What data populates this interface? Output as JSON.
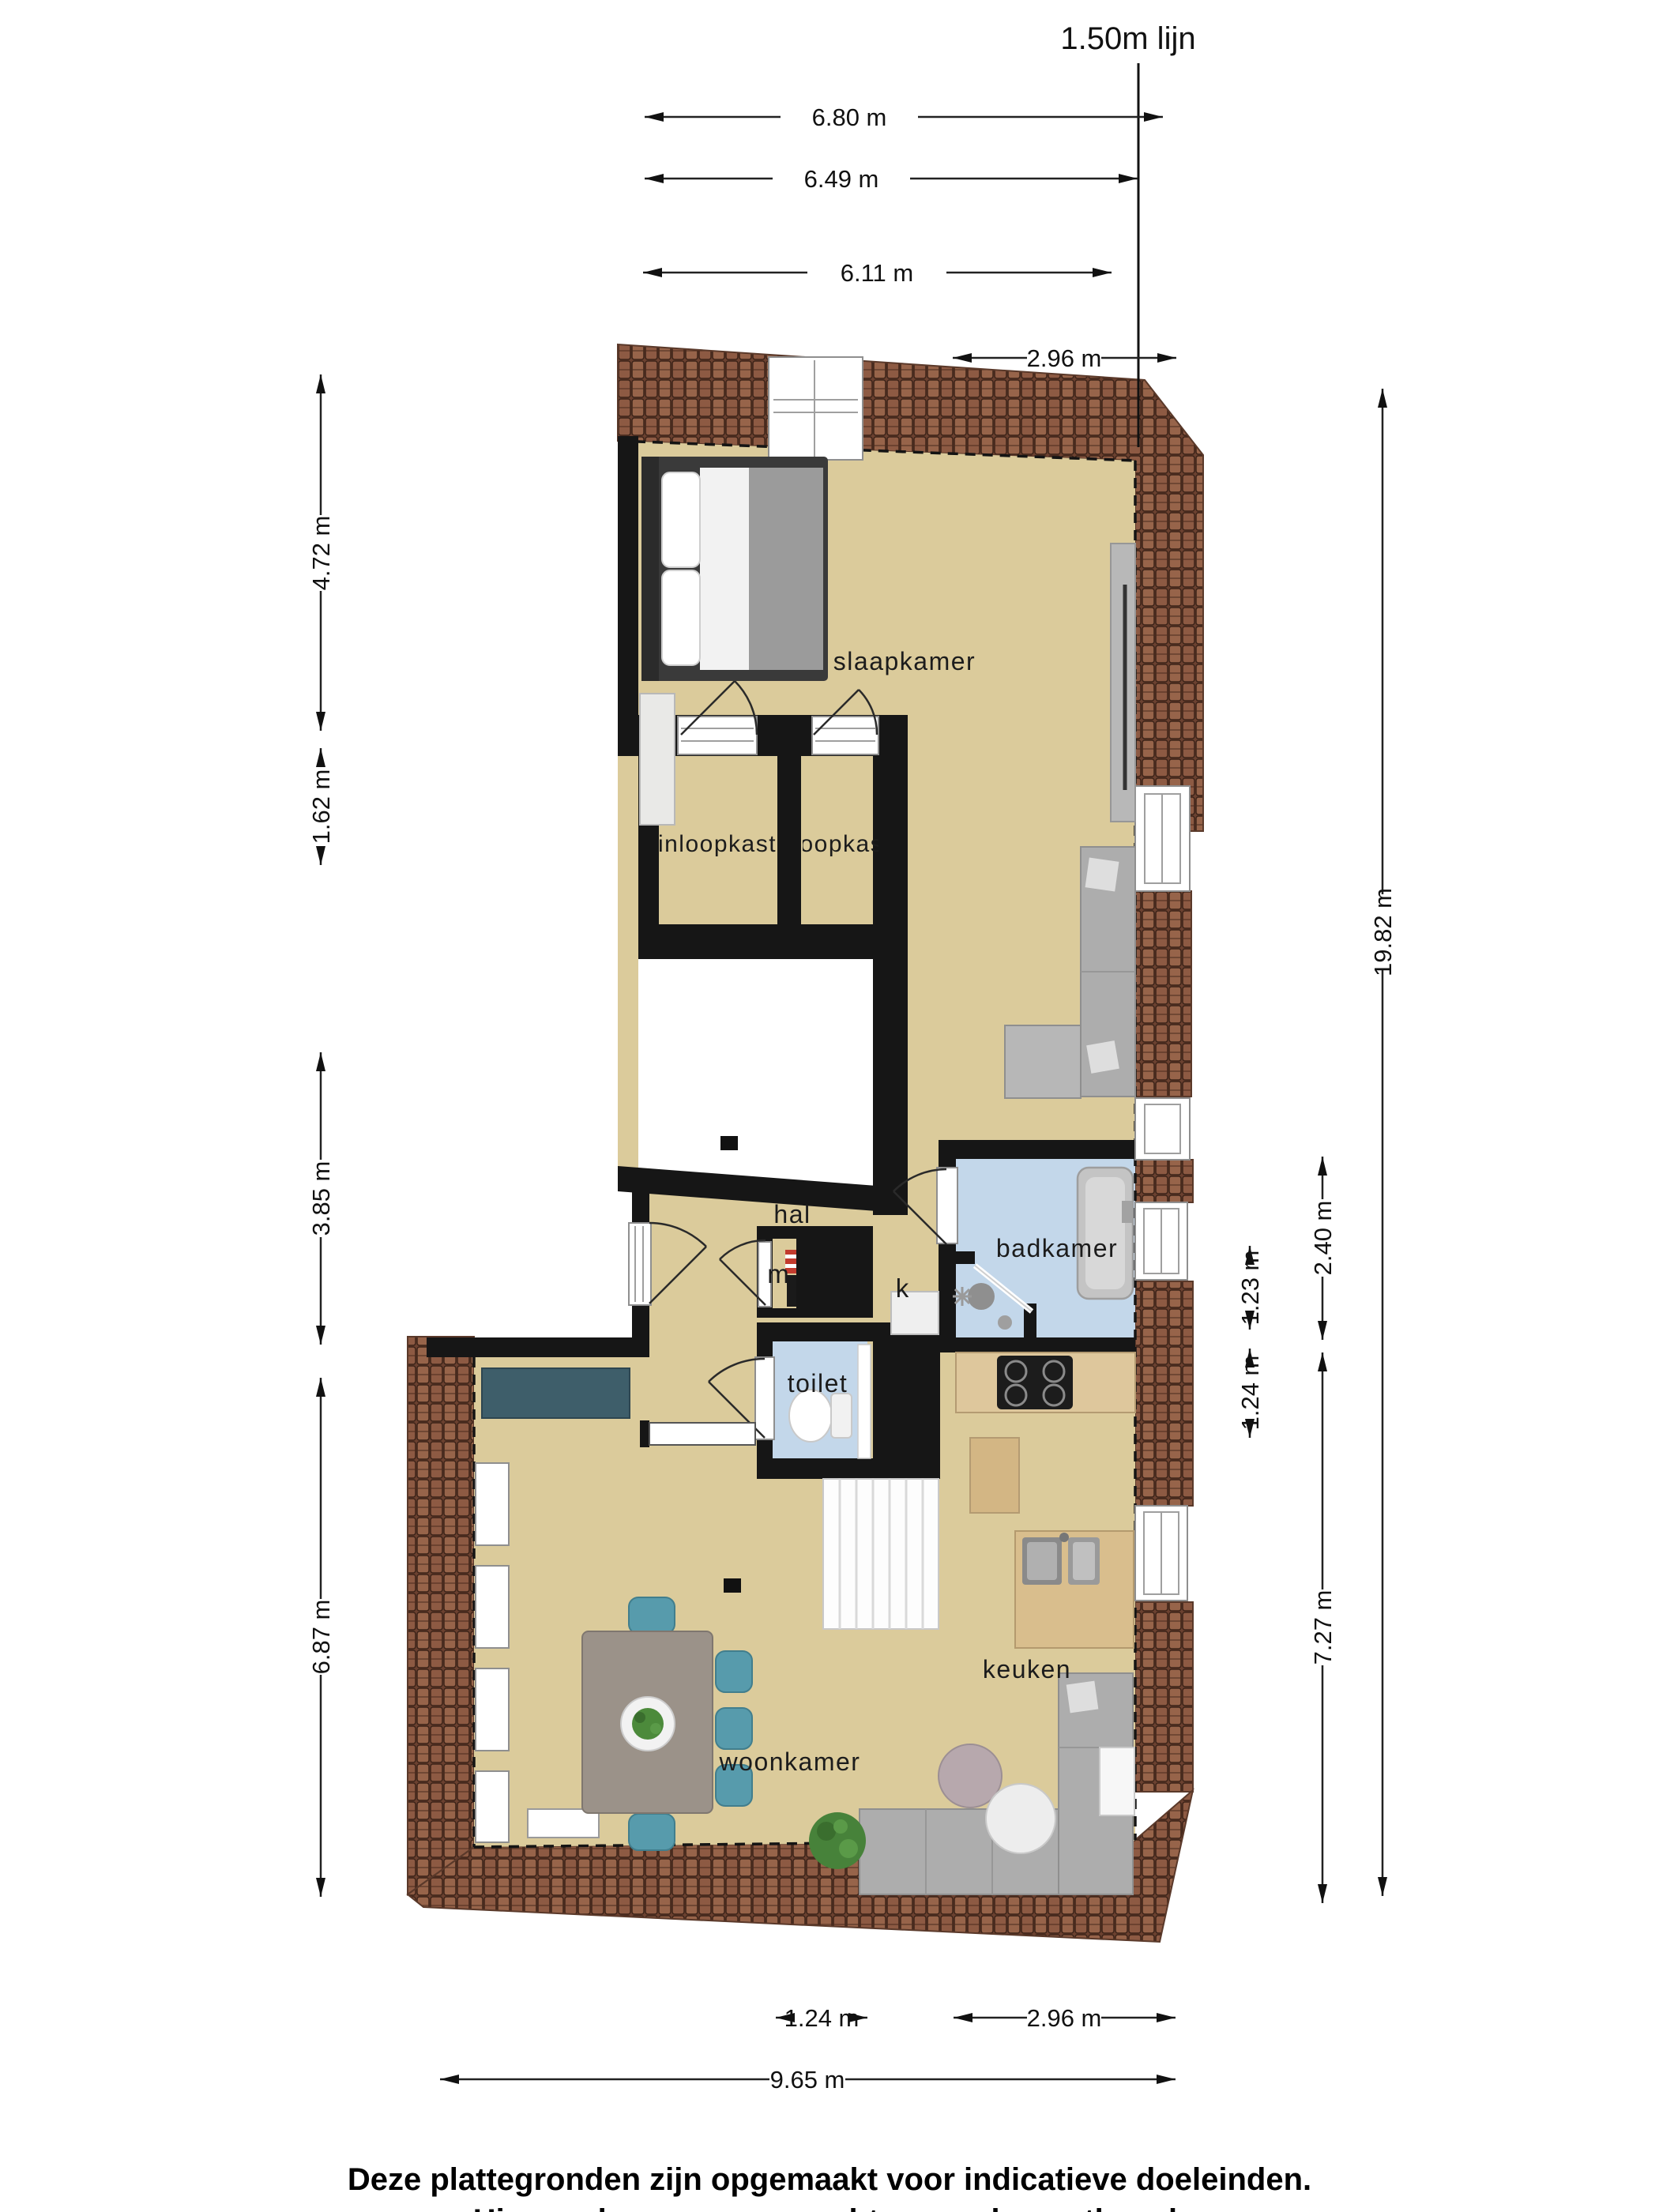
{
  "title": "1.50m lijn",
  "rooms": {
    "slaapkamer": "slaapkamer",
    "inloopkast_left": "inloopkast",
    "inloopkast_right": "inloopkast",
    "hal": "hal",
    "badkamer": "badkamer",
    "toilet": "toilet",
    "keuken": "keuken",
    "woonkamer": "woonkamer",
    "meterkast": "m",
    "kast": "k"
  },
  "dimensions": {
    "top": [
      "6.80 m",
      "6.49 m",
      "6.11 m",
      "2.96 m"
    ],
    "left": [
      "4.72 m",
      "1.62 m",
      "3.85 m",
      "6.87 m"
    ],
    "right": [
      "19.82 m",
      "2.40 m",
      "1.23 m",
      "1.24 m",
      "7.27 m"
    ],
    "bottom": [
      "1.24 m",
      "2.96 m",
      "9.65 m"
    ]
  },
  "footer": [
    "Deze plattegronden zijn opgemaakt voor indicatieve doeleinden.",
    "Hieraan kunnen geen rechten worden ontleend."
  ],
  "colors": {
    "floor": "#dbcb9b",
    "wet_room": "#c3d7ea",
    "wall": "#161616",
    "roof_tile": "#8d5a43",
    "counter_teal": "#3e5e6a",
    "kitchen_wood": "#dec79c",
    "sofa_gray": "#adadad",
    "chair_teal": "#579bac",
    "plant_green": "#4c8a3b"
  }
}
